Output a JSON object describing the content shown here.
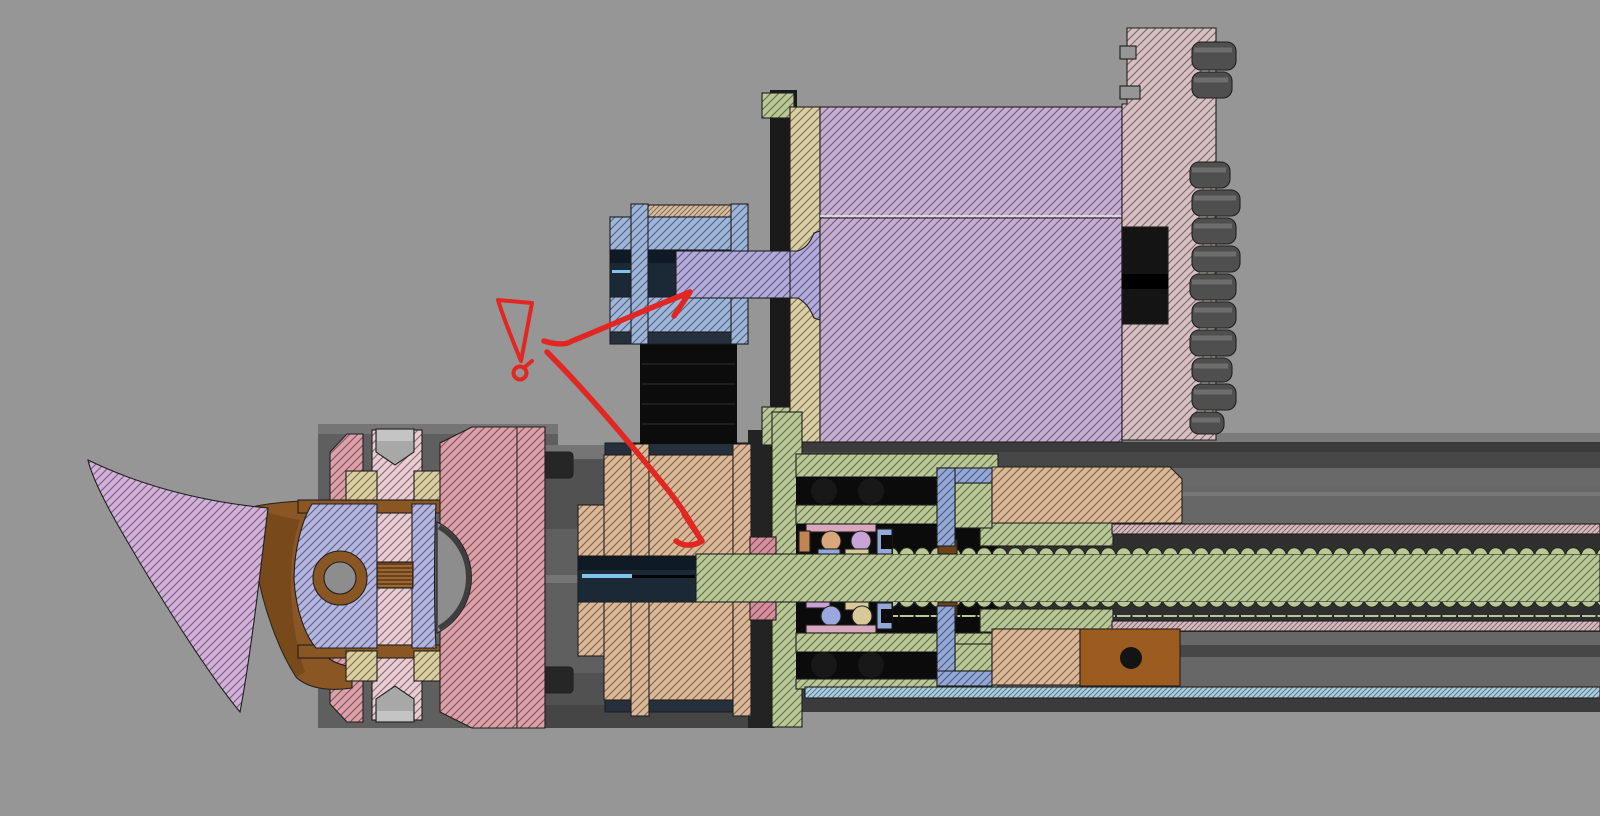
{
  "view": {
    "type": "cad-section-view",
    "background": "#969696",
    "description": "Cross-section of a lathe cross-slide assembly: stepper motor driving a timing-belt reduction to a lead screw, with bearing block, drive nut, linear rails and quick-change toolpost with cutting insert; red reviewer ink marks a surface-finish tick with leaders to the motor shaft and pulley bore"
  },
  "colors": {
    "toolpost_pink": "#dd9fa8",
    "blade_purple": "#d2b0da",
    "clevis_lavender": "#b4b5e2",
    "rod_pink": "#eaccd2",
    "washer_khaki": "#dccf9f",
    "pulley_tan": "#ddb896",
    "pulley_blue": "#9fb6dc",
    "belt_top_tan": "#d8bc9e",
    "shaft_purple": "#b3abde",
    "motor_plate_khaki": "#dbcfa3",
    "motor_body_lavender": "#c6aed2",
    "flange_pink": "#d8bfc2",
    "housing_green": "#b9c895",
    "nut_liner_pink": "#d9bac0",
    "rail_blue": "#a9cfe2",
    "bracket_blue": "#92a8d8",
    "retainer_pink": "#d9a8bc",
    "side_pink": "#d78f9d",
    "ball_tan": "#d8a87c",
    "ball_purple": "#c9a3d6",
    "ball_periwinkle": "#9aa8dd",
    "ball_khaki": "#d8c89a",
    "copper": "#c08552"
  },
  "solids": {
    "holder_brown": "#8a5724",
    "holder_brown_dark": "#5f3a12",
    "block_brown": "#9c5c20",
    "spring_brown": "#6e4218",
    "spring_light": "#a57440",
    "dome_gray": "#8d8d8d",
    "nut_gray": "#a8a8a8",
    "nut_light": "#c4c4c4",
    "belt_black": "#0c0c0c",
    "belt_streak": "#1e1e1e",
    "steel_dark": "#26303c",
    "bore_navy": "#1b2836",
    "bore_deep": "#101a24",
    "bore_highlight": "#7fc4ec",
    "mount_black": "#1a1a1a",
    "cavity_black": "#0b0b0b",
    "ball_black": "#181818",
    "teeth_gray": "#4f4f4f",
    "teeth_light": "#6e6e6e",
    "hole_black": "#141414",
    "body_light": "#757575",
    "body_mid": "#5f5f5f",
    "body_shade": "#515151",
    "body_deep": "#454545",
    "rail_top": "#7b7b7b",
    "rail_upper": "#696969",
    "rail_mid": "#565656",
    "rail_dark": "#474747",
    "corridor_dark": "#2f2f2f",
    "rail_lower": "#676767",
    "rail_lowlight": "#787878",
    "rail_bottom": "#3b3b3b",
    "slot_dark": "#232323",
    "bolt_dark": "#262626",
    "seam_light": "#e6e6e6"
  },
  "annotation": {
    "ink": "#e22621",
    "marks": [
      "surface-finish-tick",
      "small-circle-note",
      "leader-to-motor-shaft",
      "leader-to-pulley-bore"
    ]
  },
  "parts": [
    {
      "name": "cutting-insert-blade",
      "color": "blade_purple"
    },
    {
      "name": "tool-holder-bracket",
      "color": "holder_brown"
    },
    {
      "name": "clevis-link",
      "color": "clevis_lavender"
    },
    {
      "name": "clamp-stud",
      "color": "rod_pink"
    },
    {
      "name": "spherical-washers",
      "color": "washer_khaki"
    },
    {
      "name": "toolpost-block",
      "color": "toolpost_pink"
    },
    {
      "name": "drive-pulley-large",
      "color": "pulley_tan"
    },
    {
      "name": "timing-belt",
      "color": "belt_black"
    },
    {
      "name": "motor-pulley-small",
      "color": "pulley_blue"
    },
    {
      "name": "motor-shaft",
      "color": "shaft_purple"
    },
    {
      "name": "motor-front-plate",
      "color": "motor_plate_khaki"
    },
    {
      "name": "motor-body",
      "color": "motor_body_lavender"
    },
    {
      "name": "motor-rear-flange",
      "color": "flange_pink"
    },
    {
      "name": "bearing-housing",
      "color": "housing_green"
    },
    {
      "name": "lead-screw",
      "color": "housing_green"
    },
    {
      "name": "drive-nut-liner",
      "color": "nut_liner_pink"
    },
    {
      "name": "nut-bracket",
      "color": "bracket_blue"
    },
    {
      "name": "nut-carrier-block",
      "color": "block_brown"
    },
    {
      "name": "linear-rail-strip",
      "color": "rail_blue"
    }
  ]
}
